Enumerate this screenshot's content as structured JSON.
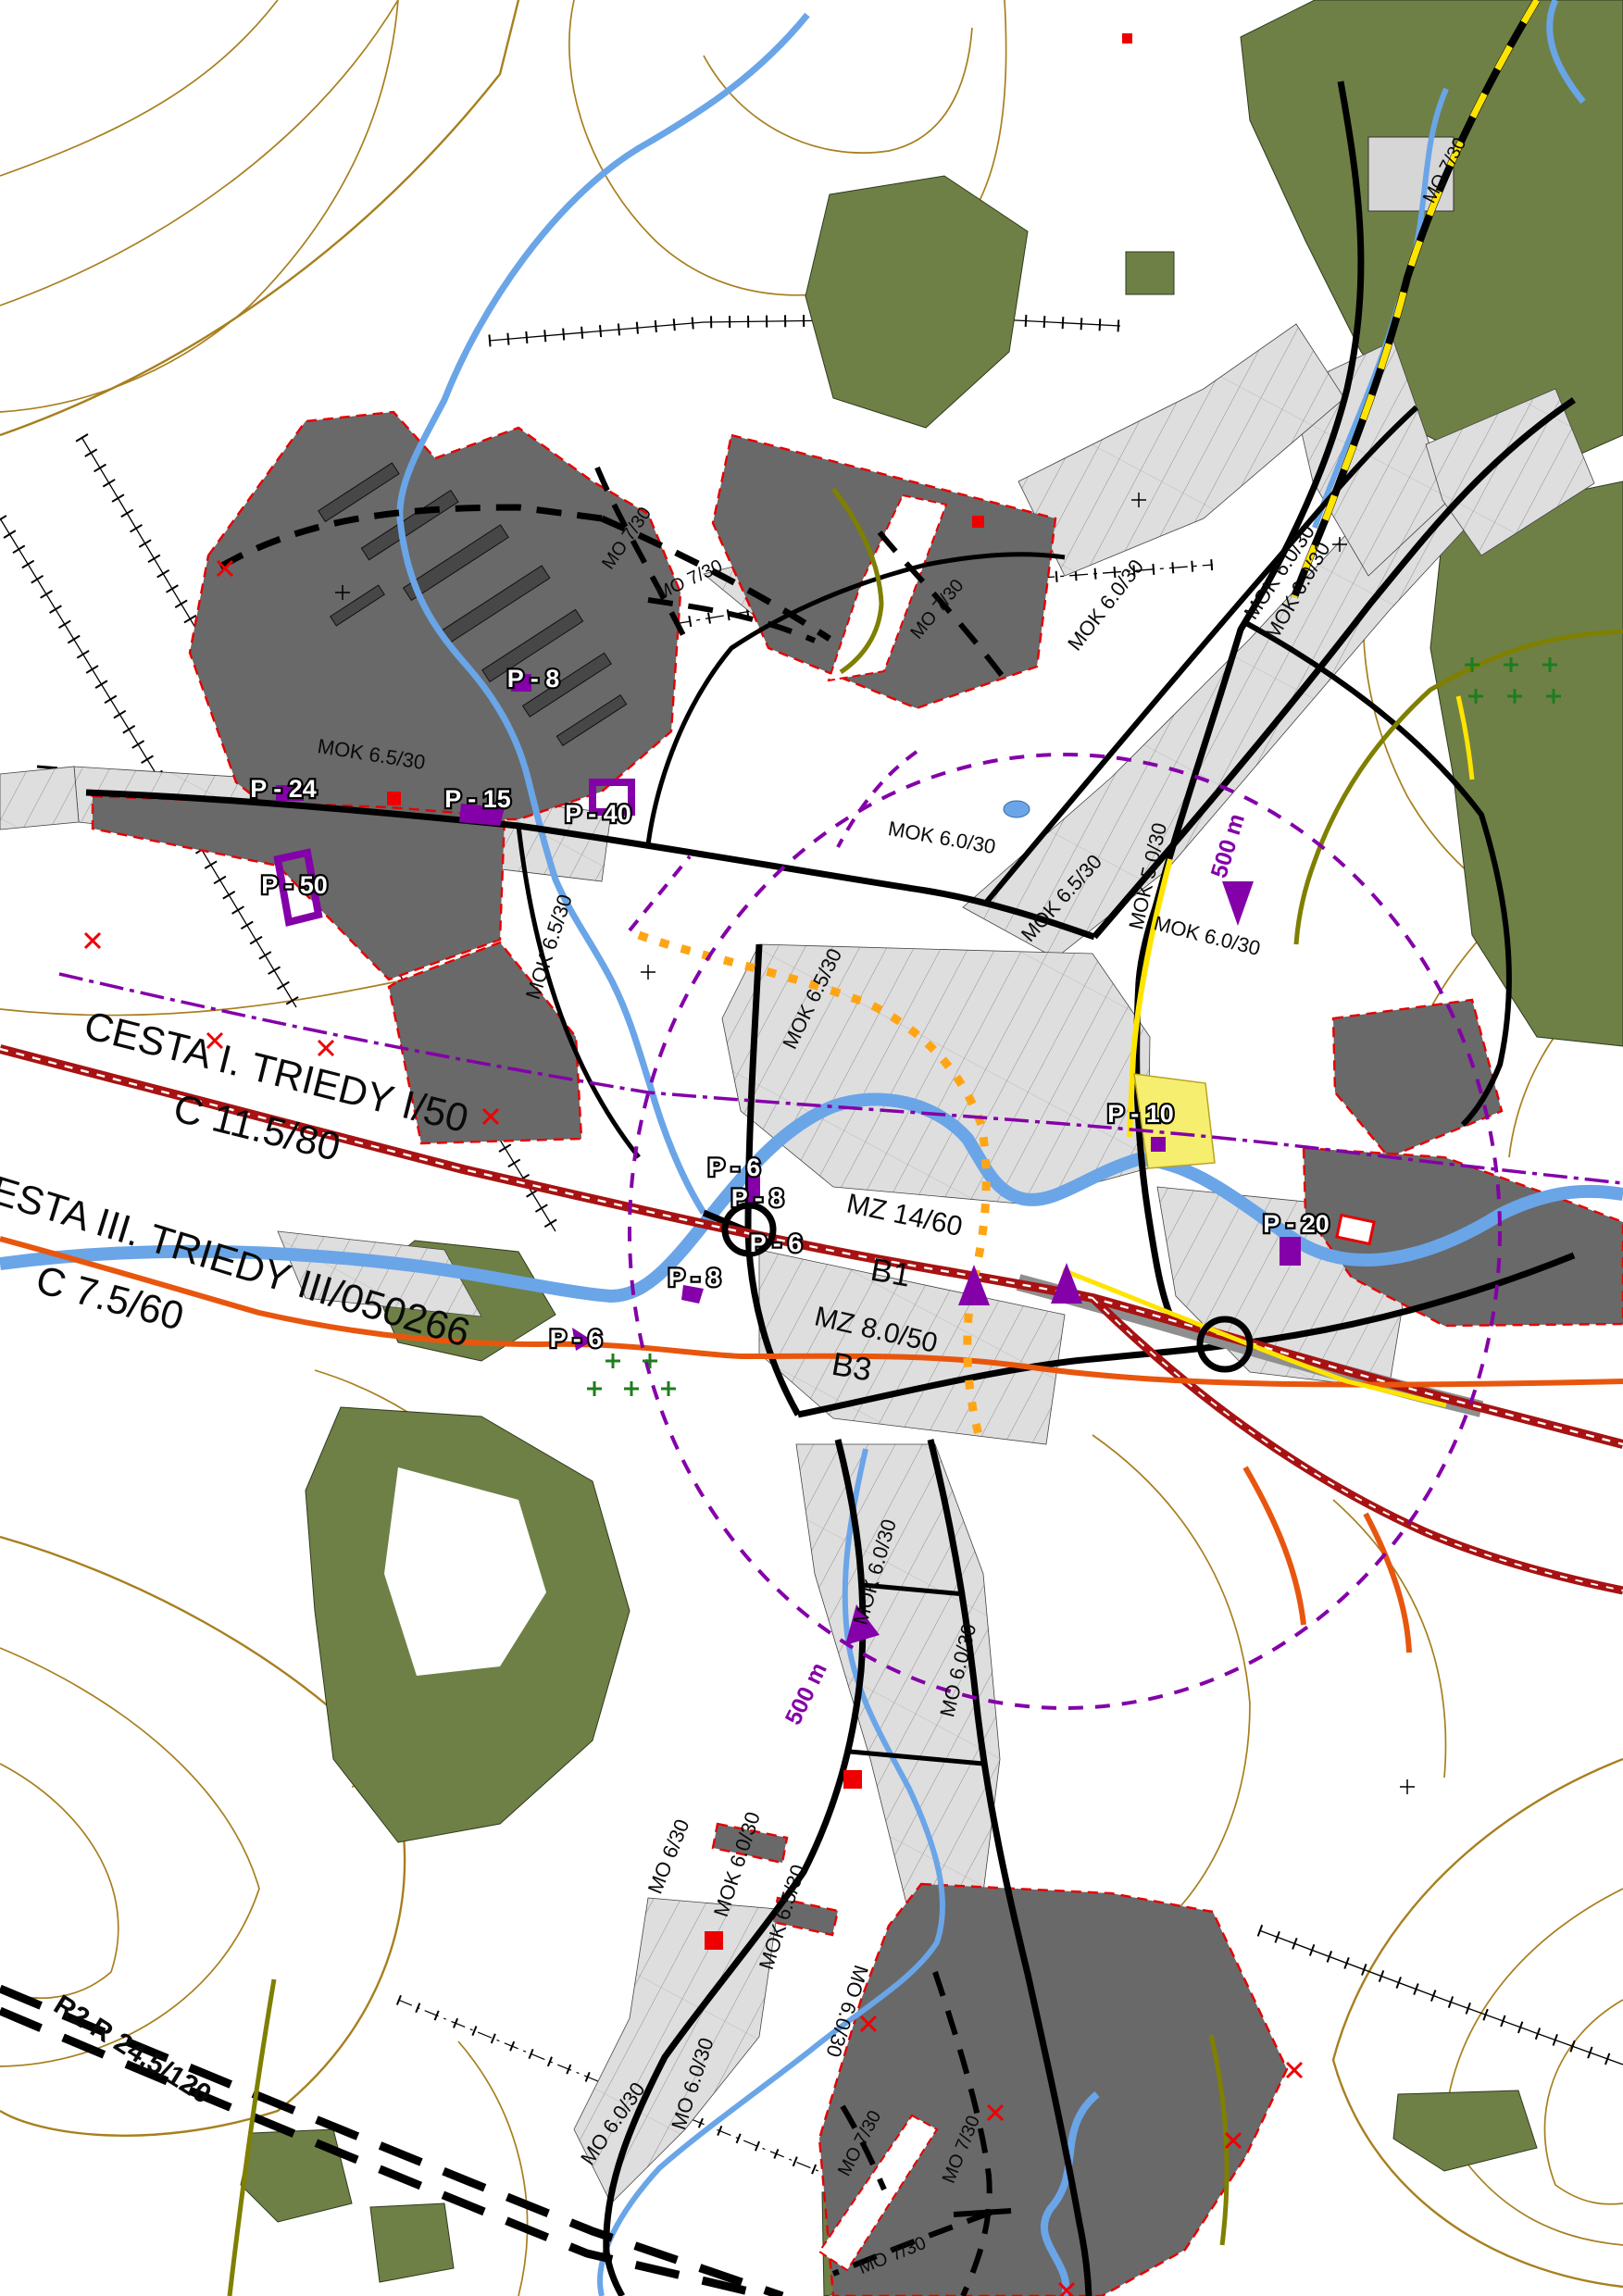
{
  "map_title": "Uzemny plan obce - doprava",
  "colors": {
    "contour": "#a87f1e",
    "forest": "#6e8045",
    "zone": "#696969",
    "zred": "#e60000",
    "river": "#6aa5e8",
    "rred": "#a81212",
    "orange": "#e8560e",
    "yellow": "#ffe400",
    "olive": "#7f7f00",
    "purple": "#8400a8",
    "mred": "#ee0000",
    "gcross": "#1e7d1e"
  },
  "legend_semantics": {
    "dark_zone": "development / industrial area with red dashed boundary",
    "purple_circle": "500 m walking radius",
    "red_double_line": "road I. class corridor",
    "orange_line": "road III. class",
    "black_dashed": "planned local road",
    "double_black_dashed": "planned expressway R2"
  },
  "labels": [
    {
      "text": "MO 7/30"
    },
    {
      "text": "MO 7/30"
    },
    {
      "text": "MO 7/30"
    },
    {
      "text": "MO 7/30"
    },
    {
      "text": "MOK 6.0/30"
    },
    {
      "text": "MOK 6.0/30"
    },
    {
      "text": "P - 8"
    },
    {
      "text": "MOK 6.5/30"
    },
    {
      "text": "P - 24"
    },
    {
      "text": "P - 15"
    },
    {
      "text": "P - 40"
    },
    {
      "text": "P - 50"
    },
    {
      "text": "MOK 6.5/30"
    },
    {
      "text": "MOK 6.5/30"
    },
    {
      "text": "MOK 6.0/30"
    },
    {
      "text": "MOK 6.5/30"
    },
    {
      "text": "MOK 5.0/30"
    },
    {
      "text": "MOK 6.0/30"
    },
    {
      "text": "500 m"
    },
    {
      "text": "MOK 6.0/30"
    },
    {
      "text": "CESTA I. TRIEDY I/50"
    },
    {
      "text": "C 11.5/80"
    },
    {
      "text": "CESTA III. TRIEDY III/050266"
    },
    {
      "text": "C 7.5/60"
    },
    {
      "text": "P - 6"
    },
    {
      "text": "P - 8"
    },
    {
      "text": "P - 6"
    },
    {
      "text": "P - 8"
    },
    {
      "text": "P - 6"
    },
    {
      "text": "P - 10"
    },
    {
      "text": "MZ 14/60"
    },
    {
      "text": "B1"
    },
    {
      "text": "MZ 8.0/50"
    },
    {
      "text": "B3"
    },
    {
      "text": "P - 20"
    },
    {
      "text": "MOK 6.0/30"
    },
    {
      "text": "500 m"
    },
    {
      "text": "MO 6.0/30"
    },
    {
      "text": "MO 6/30"
    },
    {
      "text": "MOK 6.0/30"
    },
    {
      "text": "MOK 6.5/30"
    },
    {
      "text": "MO 6.0/30"
    },
    {
      "text": "MO 6.0/30"
    },
    {
      "text": "MO 6.0/30"
    },
    {
      "text": "R2 R 24,5/120"
    },
    {
      "text": "MO 7/30"
    },
    {
      "text": "MO 7/30"
    },
    {
      "text": "MO 7/30"
    }
  ]
}
